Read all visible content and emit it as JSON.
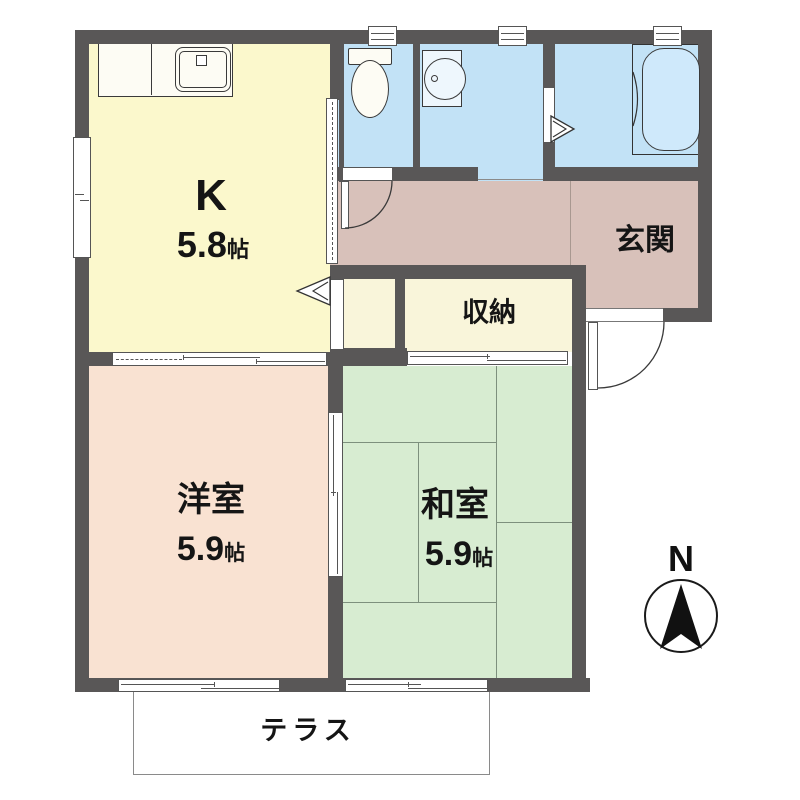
{
  "rooms": {
    "kitchen": {
      "label": "K",
      "size_value": "5.8",
      "size_unit": "帖"
    },
    "western": {
      "label": "洋室",
      "size_value": "5.9",
      "size_unit": "帖"
    },
    "japanese": {
      "label": "和室",
      "size_value": "5.9",
      "size_unit": "帖"
    },
    "entrance": {
      "label": "玄関"
    },
    "storage": {
      "label": "収納"
    },
    "terrace": {
      "label": "テラス"
    }
  },
  "compass": {
    "north_label": "N"
  },
  "fixtures": [
    "kitchen-sink",
    "toilet",
    "washbasin",
    "bathtub"
  ],
  "colors": {
    "wall": "#595757",
    "kitchen_floor": "#fbf8cc",
    "wet_room_floor": "#c2e2f6",
    "hallway_entrance_floor": "#d8c1ba",
    "closet_floor": "#f9f5da",
    "western_room_floor": "#f9e2d2",
    "japanese_room_floor": "#d7ecd1",
    "bathtub_fill": "#cfe9fb",
    "fixture_line": "#333333",
    "tatami_line": "#7d907d"
  }
}
